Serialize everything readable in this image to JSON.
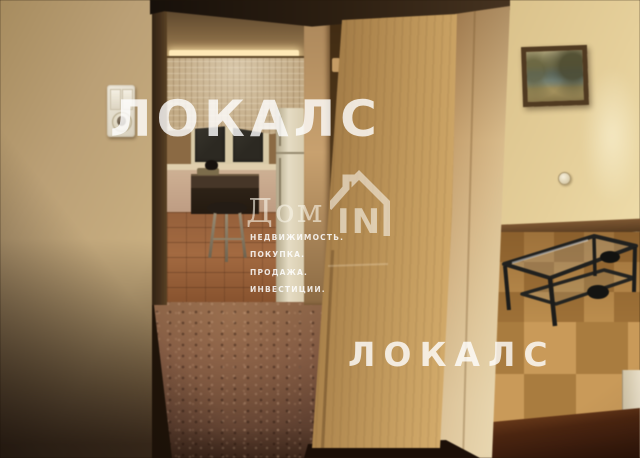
{
  "photo": {
    "subject": "apartment hallway interior with open door, kitchen doorway and living room",
    "rooms": [
      "hallway",
      "kitchen",
      "living-room"
    ],
    "objects": [
      "light-switch",
      "lace-curtain",
      "window",
      "refrigerator",
      "kitchen-table",
      "stool",
      "open-wooden-door",
      "framed-landscape-painting",
      "wall-outlet",
      "glass-coffee-table",
      "parquet-floor",
      "dark-wood-cabinet"
    ]
  },
  "watermarks": {
    "brand_top": "ЛОКАЛС",
    "brand_bottom": "ЛОКАЛС",
    "logo": {
      "prefix": "Дом",
      "suffix": "IN",
      "tagline": [
        "НЕДВИЖИМОСТЬ.",
        "ПОКУПКА.",
        "ПРОДАЖА.",
        "ИНВЕСТИЦИИ."
      ]
    }
  },
  "colors": {
    "watermark_white": "#ffffff",
    "left_wall_beige": "#bda175",
    "door_tan": "#c19a5e",
    "right_wall_yellow": "#e6d09c",
    "parquet_light": "#c89a5a",
    "parquet_dark": "#a87c40",
    "hall_floor_brown": "#7a5440",
    "painting_water_blue": "#7fa6bb"
  }
}
